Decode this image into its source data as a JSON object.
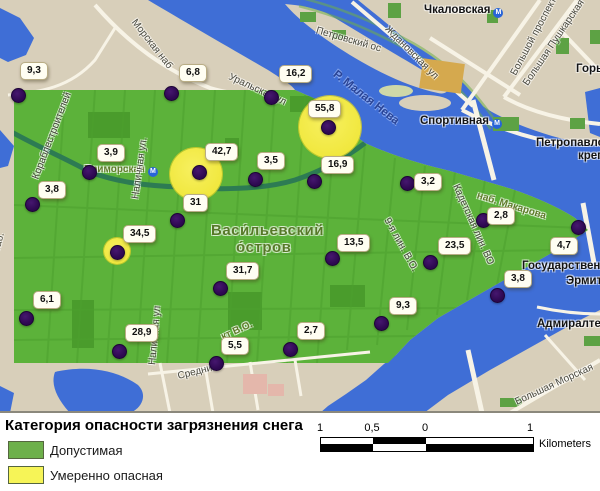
{
  "map": {
    "region_name": "Васи́льевский о́стров",
    "colors": {
      "water": "#3f6ed6",
      "land": "#d8cfba",
      "safe_green": "#5cb23a",
      "warning_yellow": "#f3ec48",
      "marker_purple": "#2d0850"
    },
    "street_labels": [
      {
        "text": "Морская наб",
        "x": 133,
        "y": 16,
        "rot": 52,
        "cls": "street"
      },
      {
        "text": "Чкаловская",
        "x": 424,
        "y": 5,
        "rot": 0,
        "cls": "place",
        "metro": true
      },
      {
        "text": "Петровский ос",
        "x": 316,
        "y": 26,
        "rot": 16,
        "cls": "street"
      },
      {
        "text": "Ждановская ул",
        "x": 386,
        "y": 23,
        "rot": 45,
        "cls": "street"
      },
      {
        "text": "Большой проспект",
        "x": 514,
        "y": 70,
        "rot": -62,
        "cls": "street"
      },
      {
        "text": "Большая Пушкарская",
        "x": 526,
        "y": 80,
        "rot": -56,
        "cls": "street"
      },
      {
        "text": "Горьковская",
        "x": 576,
        "y": 64,
        "rot": 0,
        "cls": "place"
      },
      {
        "text": "Уральская ул",
        "x": 229,
        "y": 72,
        "rot": 25,
        "cls": "street"
      },
      {
        "text": "Р. Малая Нева",
        "x": 334,
        "y": 68,
        "rot": 38,
        "cls": "river"
      },
      {
        "text": "Спортивная",
        "x": 420,
        "y": 116,
        "rot": 0,
        "cls": "place",
        "metro": true
      },
      {
        "text": "Петропавловская",
        "x": 536,
        "y": 138,
        "rot": 0,
        "cls": "place"
      },
      {
        "text": "крепость",
        "x": 578,
        "y": 151,
        "rot": 0,
        "cls": "place"
      },
      {
        "text": "Приморская",
        "x": 84,
        "y": 165,
        "rot": 0,
        "cls": "olive",
        "metro": true
      },
      {
        "text": "Кораблестроителей",
        "x": 36,
        "y": 174,
        "rot": -69,
        "cls": "street"
      },
      {
        "text": "Наличная ул.",
        "x": 136,
        "y": 194,
        "rot": -82,
        "cls": "street"
      },
      {
        "text": "Васи́льевский",
        "x": 211,
        "y": 223,
        "rot": 0,
        "cls": "island"
      },
      {
        "text": "о́стров",
        "x": 236,
        "y": 240,
        "rot": 0,
        "cls": "island"
      },
      {
        "text": "9-я лин. В.О.",
        "x": 386,
        "y": 214,
        "rot": 61,
        "cls": "street"
      },
      {
        "text": "Кадетская лин. ВО",
        "x": 455,
        "y": 180,
        "rot": 66,
        "cls": "street"
      },
      {
        "text": "наб. Макарова",
        "x": 477,
        "y": 191,
        "rot": 17,
        "cls": "olive"
      },
      {
        "text": "Государственный",
        "x": 522,
        "y": 261,
        "rot": 0,
        "cls": "place"
      },
      {
        "text": "Эрмитаж",
        "x": 566,
        "y": 276,
        "rot": 0,
        "cls": "place"
      },
      {
        "text": "Адмиралтейский",
        "x": 537,
        "y": 319,
        "rot": 0,
        "cls": "place"
      },
      {
        "text": "Большая Морская",
        "x": 516,
        "y": 398,
        "rot": -25,
        "cls": "street"
      },
      {
        "text": "Средний",
        "x": 178,
        "y": 372,
        "rot": -14,
        "cls": "street"
      },
      {
        "text": "кт В.О.",
        "x": 222,
        "y": 333,
        "rot": -24,
        "cls": "olive"
      },
      {
        "text": "наб.",
        "x": -3,
        "y": 247,
        "rot": -75,
        "cls": "street"
      },
      {
        "text": "Наличная ул",
        "x": 153,
        "y": 360,
        "rot": -85,
        "cls": "street"
      }
    ],
    "points": [
      {
        "value": "9,3",
        "dot_x": 18,
        "dot_y": 95,
        "label_x": 20,
        "label_y": 62
      },
      {
        "value": "6,8",
        "dot_x": 171,
        "dot_y": 93,
        "label_x": 179,
        "label_y": 64
      },
      {
        "value": "16,2",
        "dot_x": 271,
        "dot_y": 97,
        "label_x": 279,
        "label_y": 65
      },
      {
        "value": "55,8",
        "dot_x": 328,
        "dot_y": 127,
        "label_x": 308,
        "label_y": 100
      },
      {
        "value": "3,9",
        "dot_x": 89,
        "dot_y": 172,
        "label_x": 97,
        "label_y": 144
      },
      {
        "value": "42,7",
        "dot_x": 199,
        "dot_y": 172,
        "label_x": 205,
        "label_y": 143
      },
      {
        "value": "3,5",
        "dot_x": 255,
        "dot_y": 179,
        "label_x": 257,
        "label_y": 152
      },
      {
        "value": "16,9",
        "dot_x": 314,
        "dot_y": 181,
        "label_x": 321,
        "label_y": 156
      },
      {
        "value": "3,2",
        "dot_x": 407,
        "dot_y": 183,
        "label_x": 414,
        "label_y": 173
      },
      {
        "value": "3,8",
        "dot_x": 32,
        "dot_y": 204,
        "label_x": 38,
        "label_y": 181
      },
      {
        "value": "31",
        "dot_x": 177,
        "dot_y": 220,
        "label_x": 183,
        "label_y": 194
      },
      {
        "value": "2,8",
        "dot_x": 483,
        "dot_y": 220,
        "label_x": 487,
        "label_y": 207
      },
      {
        "value": "4,7",
        "dot_x": 578,
        "dot_y": 227,
        "label_x": 550,
        "label_y": 237
      },
      {
        "value": "34,5",
        "dot_x": 117,
        "dot_y": 252,
        "label_x": 123,
        "label_y": 225
      },
      {
        "value": "13,5",
        "dot_x": 332,
        "dot_y": 258,
        "label_x": 337,
        "label_y": 234
      },
      {
        "value": "23,5",
        "dot_x": 430,
        "dot_y": 262,
        "label_x": 438,
        "label_y": 237
      },
      {
        "value": "3,8",
        "dot_x": 497,
        "dot_y": 295,
        "label_x": 504,
        "label_y": 270
      },
      {
        "value": "31,7",
        "dot_x": 220,
        "dot_y": 288,
        "label_x": 226,
        "label_y": 262
      },
      {
        "value": "6,1",
        "dot_x": 26,
        "dot_y": 318,
        "label_x": 33,
        "label_y": 291
      },
      {
        "value": "9,3",
        "dot_x": 381,
        "dot_y": 323,
        "label_x": 389,
        "label_y": 297
      },
      {
        "value": "28,9",
        "dot_x": 119,
        "dot_y": 351,
        "label_x": 125,
        "label_y": 324
      },
      {
        "value": "2,7",
        "dot_x": 290,
        "dot_y": 349,
        "label_x": 297,
        "label_y": 322
      },
      {
        "value": "5,5",
        "dot_x": 216,
        "dot_y": 363,
        "label_x": 221,
        "label_y": 337
      }
    ],
    "danger_circles": [
      {
        "x": 330,
        "y": 127,
        "r": 31
      },
      {
        "x": 196,
        "y": 174,
        "r": 26
      },
      {
        "x": 117,
        "y": 251,
        "r": 13
      }
    ]
  },
  "legend": {
    "title": "Категория опасности загрязнения снега",
    "items": [
      {
        "label": "Допустимая",
        "color": "#6db04a"
      },
      {
        "label": "Умеренно опасная",
        "color": "#f6f457"
      }
    ]
  },
  "scalebar": {
    "tick_labels": [
      {
        "text": "1",
        "x": 320
      },
      {
        "text": "0,5",
        "x": 372
      },
      {
        "text": "0",
        "x": 425
      },
      {
        "text": "1",
        "x": 530
      }
    ],
    "unit": "Kilometers"
  }
}
